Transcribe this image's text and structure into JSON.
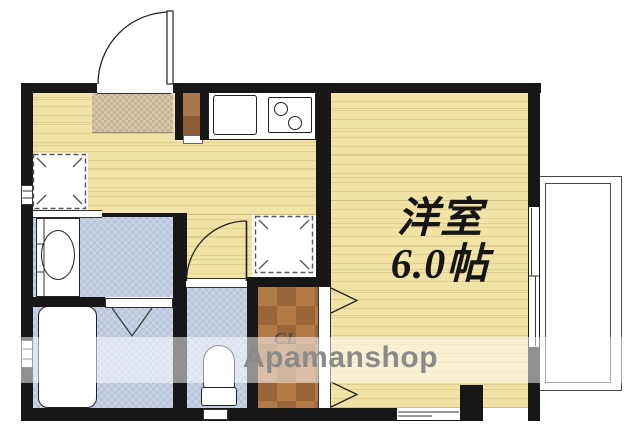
{
  "labels": {
    "room_name": "洋室",
    "room_size": "6.0帖",
    "closet": "CL",
    "watermark": "Apamanshop"
  },
  "colors": {
    "wall": "#171717",
    "wood_floor": "#f1e2a6",
    "tile_floor": "#c7d2e4",
    "mat_floor": "#d7c5ac",
    "closet_floor": "#b27a46",
    "cabinet_brown": "#a9764e",
    "line": "#222222",
    "balcony_line": "#4a4a4a",
    "watermark_text": "#8a8a8a",
    "watermark_band": "rgba(255,255,255,0.52)"
  },
  "icons": {
    "entrance_door": "door-swing-arc",
    "toilet_door": "door-swing-arc",
    "bathroom_door": "folding-door-v",
    "closet_door": "folding-door-chevron",
    "laundry_space": "dashed-square-placeholder",
    "refrigerator_space": "dashed-square-placeholder",
    "kitchen_sink": "sink-rect",
    "stove": "two-burner-stove",
    "washbasin": "oval-basin",
    "bathtub": "bathtub-rounded-rect",
    "toilet": "toilet-bowl-and-tank",
    "balcony": "double-line-rect",
    "windows": "wall-gap-window"
  }
}
